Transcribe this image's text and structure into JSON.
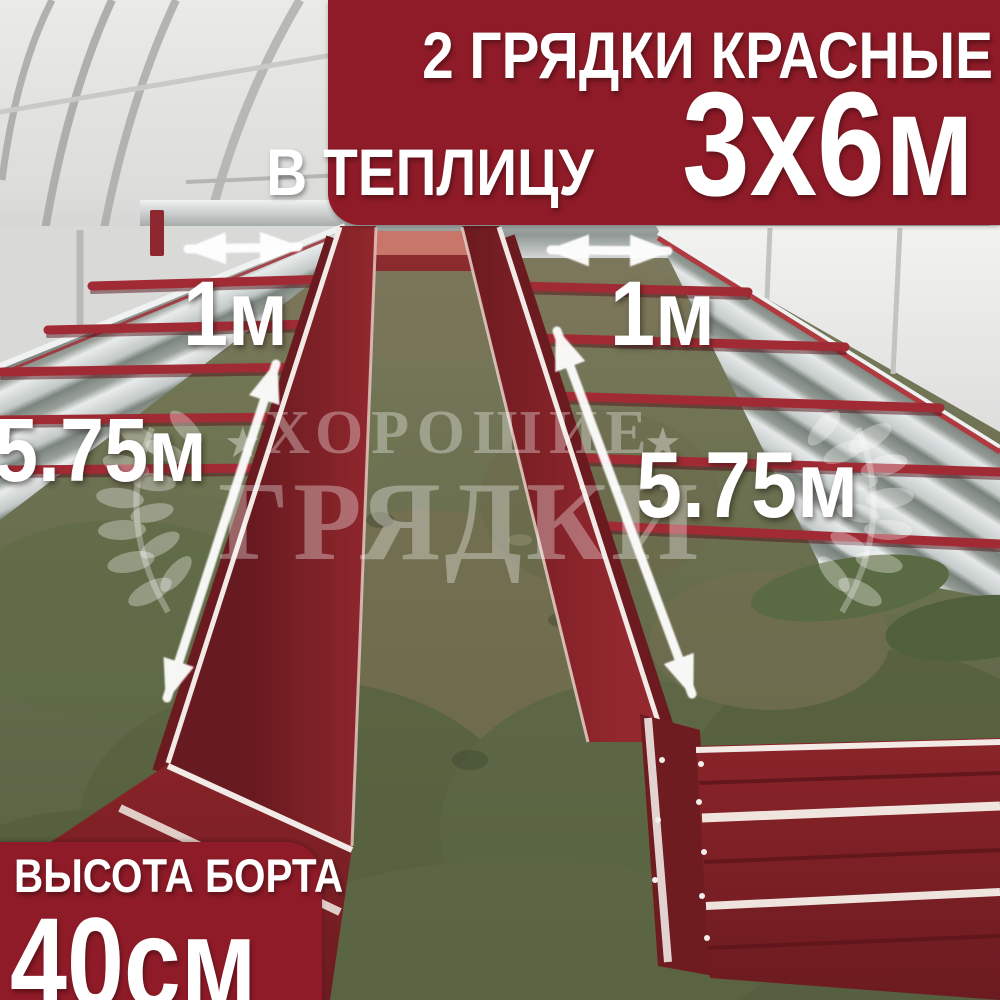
{
  "top_banner": {
    "line1": "2 ГРЯДКИ КРАСНЫЕ",
    "line2_text": "В ТЕПЛИЦУ",
    "line2_value": "3х6м"
  },
  "bottom_banner": {
    "title": "ВЫСОТА БОРТА",
    "value": "40см"
  },
  "dimensions": {
    "left_bed_width": "1м",
    "right_bed_width": "1м",
    "left_bed_length": "5.75м",
    "right_bed_length": "5.75м"
  },
  "watermark": {
    "line1": "ХОРОШИЕ",
    "line2": "ГРЯДКИ",
    "star": "★"
  },
  "colors": {
    "banner_red": "#8e1b27",
    "bed_red": "#7f2026",
    "bed_rail_white": "#f2eae6",
    "metal_silver": "#d8dbdc",
    "grass_green": "#68704d"
  }
}
